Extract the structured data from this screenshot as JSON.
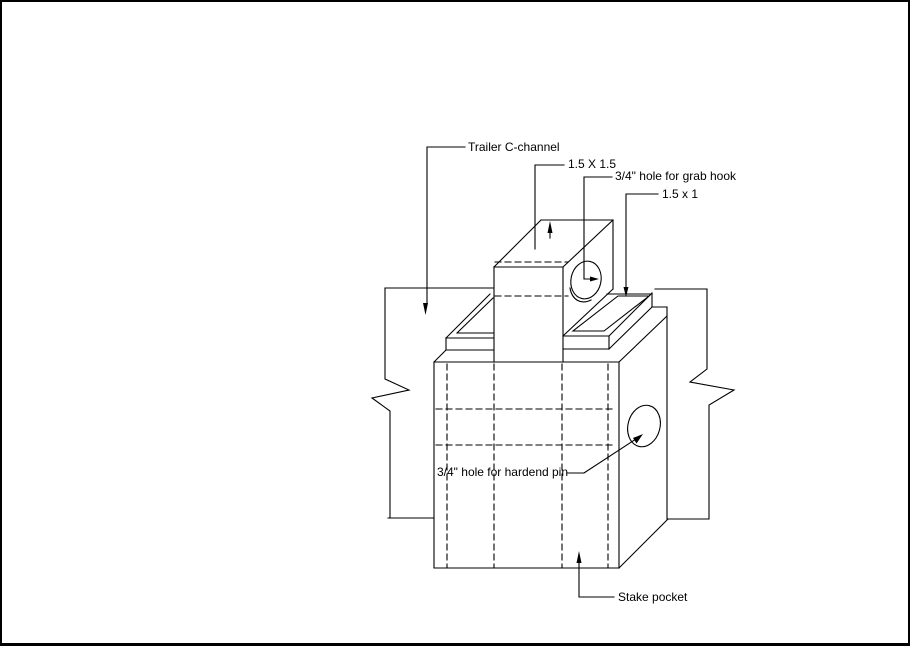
{
  "diagram": {
    "type": "isometric-cad-drawing",
    "subject": "Trailer stake pocket weldment detail",
    "labels": {
      "trailer_c_channel": "Trailer C-channel",
      "tube_size": "1.5 X 1.5",
      "grab_hook_hole": "3/4\" hole for grab hook",
      "plate_size": "1.5 x 1",
      "hardend_pin_hole": "3/4\" hole for hardend pin",
      "stake_pocket": "Stake pocket"
    },
    "colors": {
      "line": "#000000",
      "background": "#ffffff",
      "border": "#000000"
    }
  }
}
